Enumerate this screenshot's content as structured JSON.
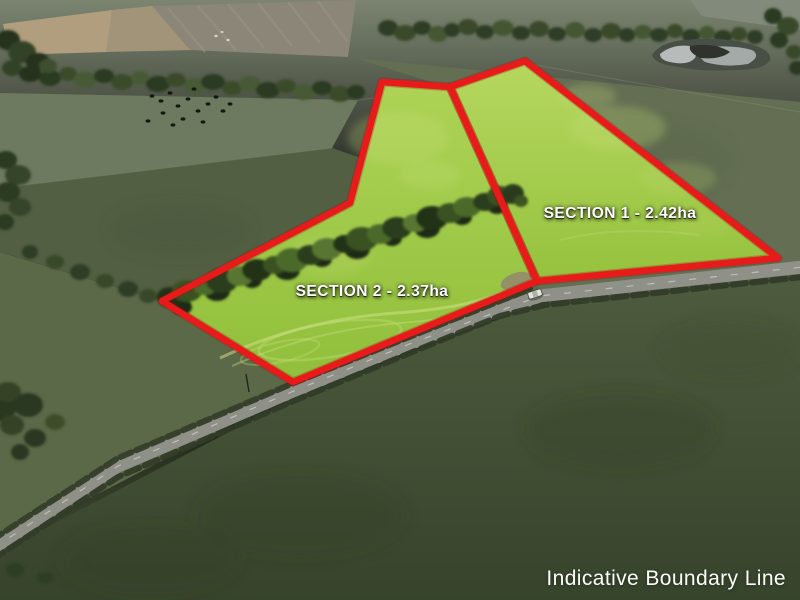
{
  "photo": {
    "kind": "aerial-drone-farmland-photo"
  },
  "sections": [
    {
      "name": "section-1",
      "label": "SECTION 1 - 2.42ha",
      "area_ha": "2.42",
      "points": "450,87 525,61 778,258 537,281"
    },
    {
      "name": "section-2",
      "label": "SECTION 2 - 2.37ha",
      "area_ha": "2.37",
      "points": "382,82 450,87 537,281 293,382 162,301 350,203"
    }
  ],
  "footer": {
    "disclaimer": "Indicative Boundary Line"
  },
  "colors": {
    "boundary_red": "#e81a1a",
    "highlight_green": "#a3cf45",
    "label_text": "#ffffff"
  }
}
